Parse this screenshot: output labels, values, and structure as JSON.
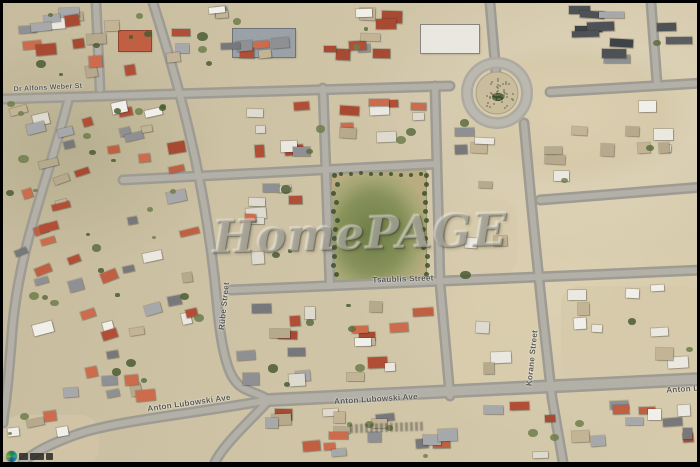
{
  "image_type": "aerial-satellite-photo",
  "watermark": {
    "text": "HomePAGE"
  },
  "streets": [
    {
      "name": "dr-alfons-weber",
      "text": "Dr Alfons Weber St"
    },
    {
      "name": "rube-street",
      "text": "Rübe Street"
    },
    {
      "name": "tsaublis-street",
      "text": "Tsaublis Street"
    },
    {
      "name": "korane-street",
      "text": "Korane Street"
    },
    {
      "name": "anton-lubowski-ave-left",
      "text": "Anton Lubowski Ave"
    },
    {
      "name": "anton-lubowski-ave-mid",
      "text": "Anton Lubowski Ave"
    },
    {
      "name": "anton-lubowski-ave-right",
      "text": "Anton Lu"
    }
  ],
  "colors": {
    "frame": "#000000",
    "sand": "#cfc3a6",
    "sand_light": "#d9cdaf",
    "road": "#9e9b93",
    "road_light": "#b6b3ab",
    "park_green": "#87915a",
    "tree": "#3c4f2a",
    "roof_red": [
      "#b24e36",
      "#c05f41",
      "#a84a31",
      "#cd6c4c"
    ],
    "roof_white": [
      "#eae8e1",
      "#dedacf",
      "#f1efe9"
    ],
    "roof_gray": [
      "#8f9094",
      "#76787c",
      "#a6a8ab"
    ],
    "roof_dark": [
      "#4e5156",
      "#3f4246",
      "#5a5d62"
    ],
    "roof_tan": [
      "#c3b496",
      "#b7a98c"
    ],
    "veg": [
      "#5c6d40",
      "#4a5c33",
      "#6e7e4b"
    ]
  }
}
